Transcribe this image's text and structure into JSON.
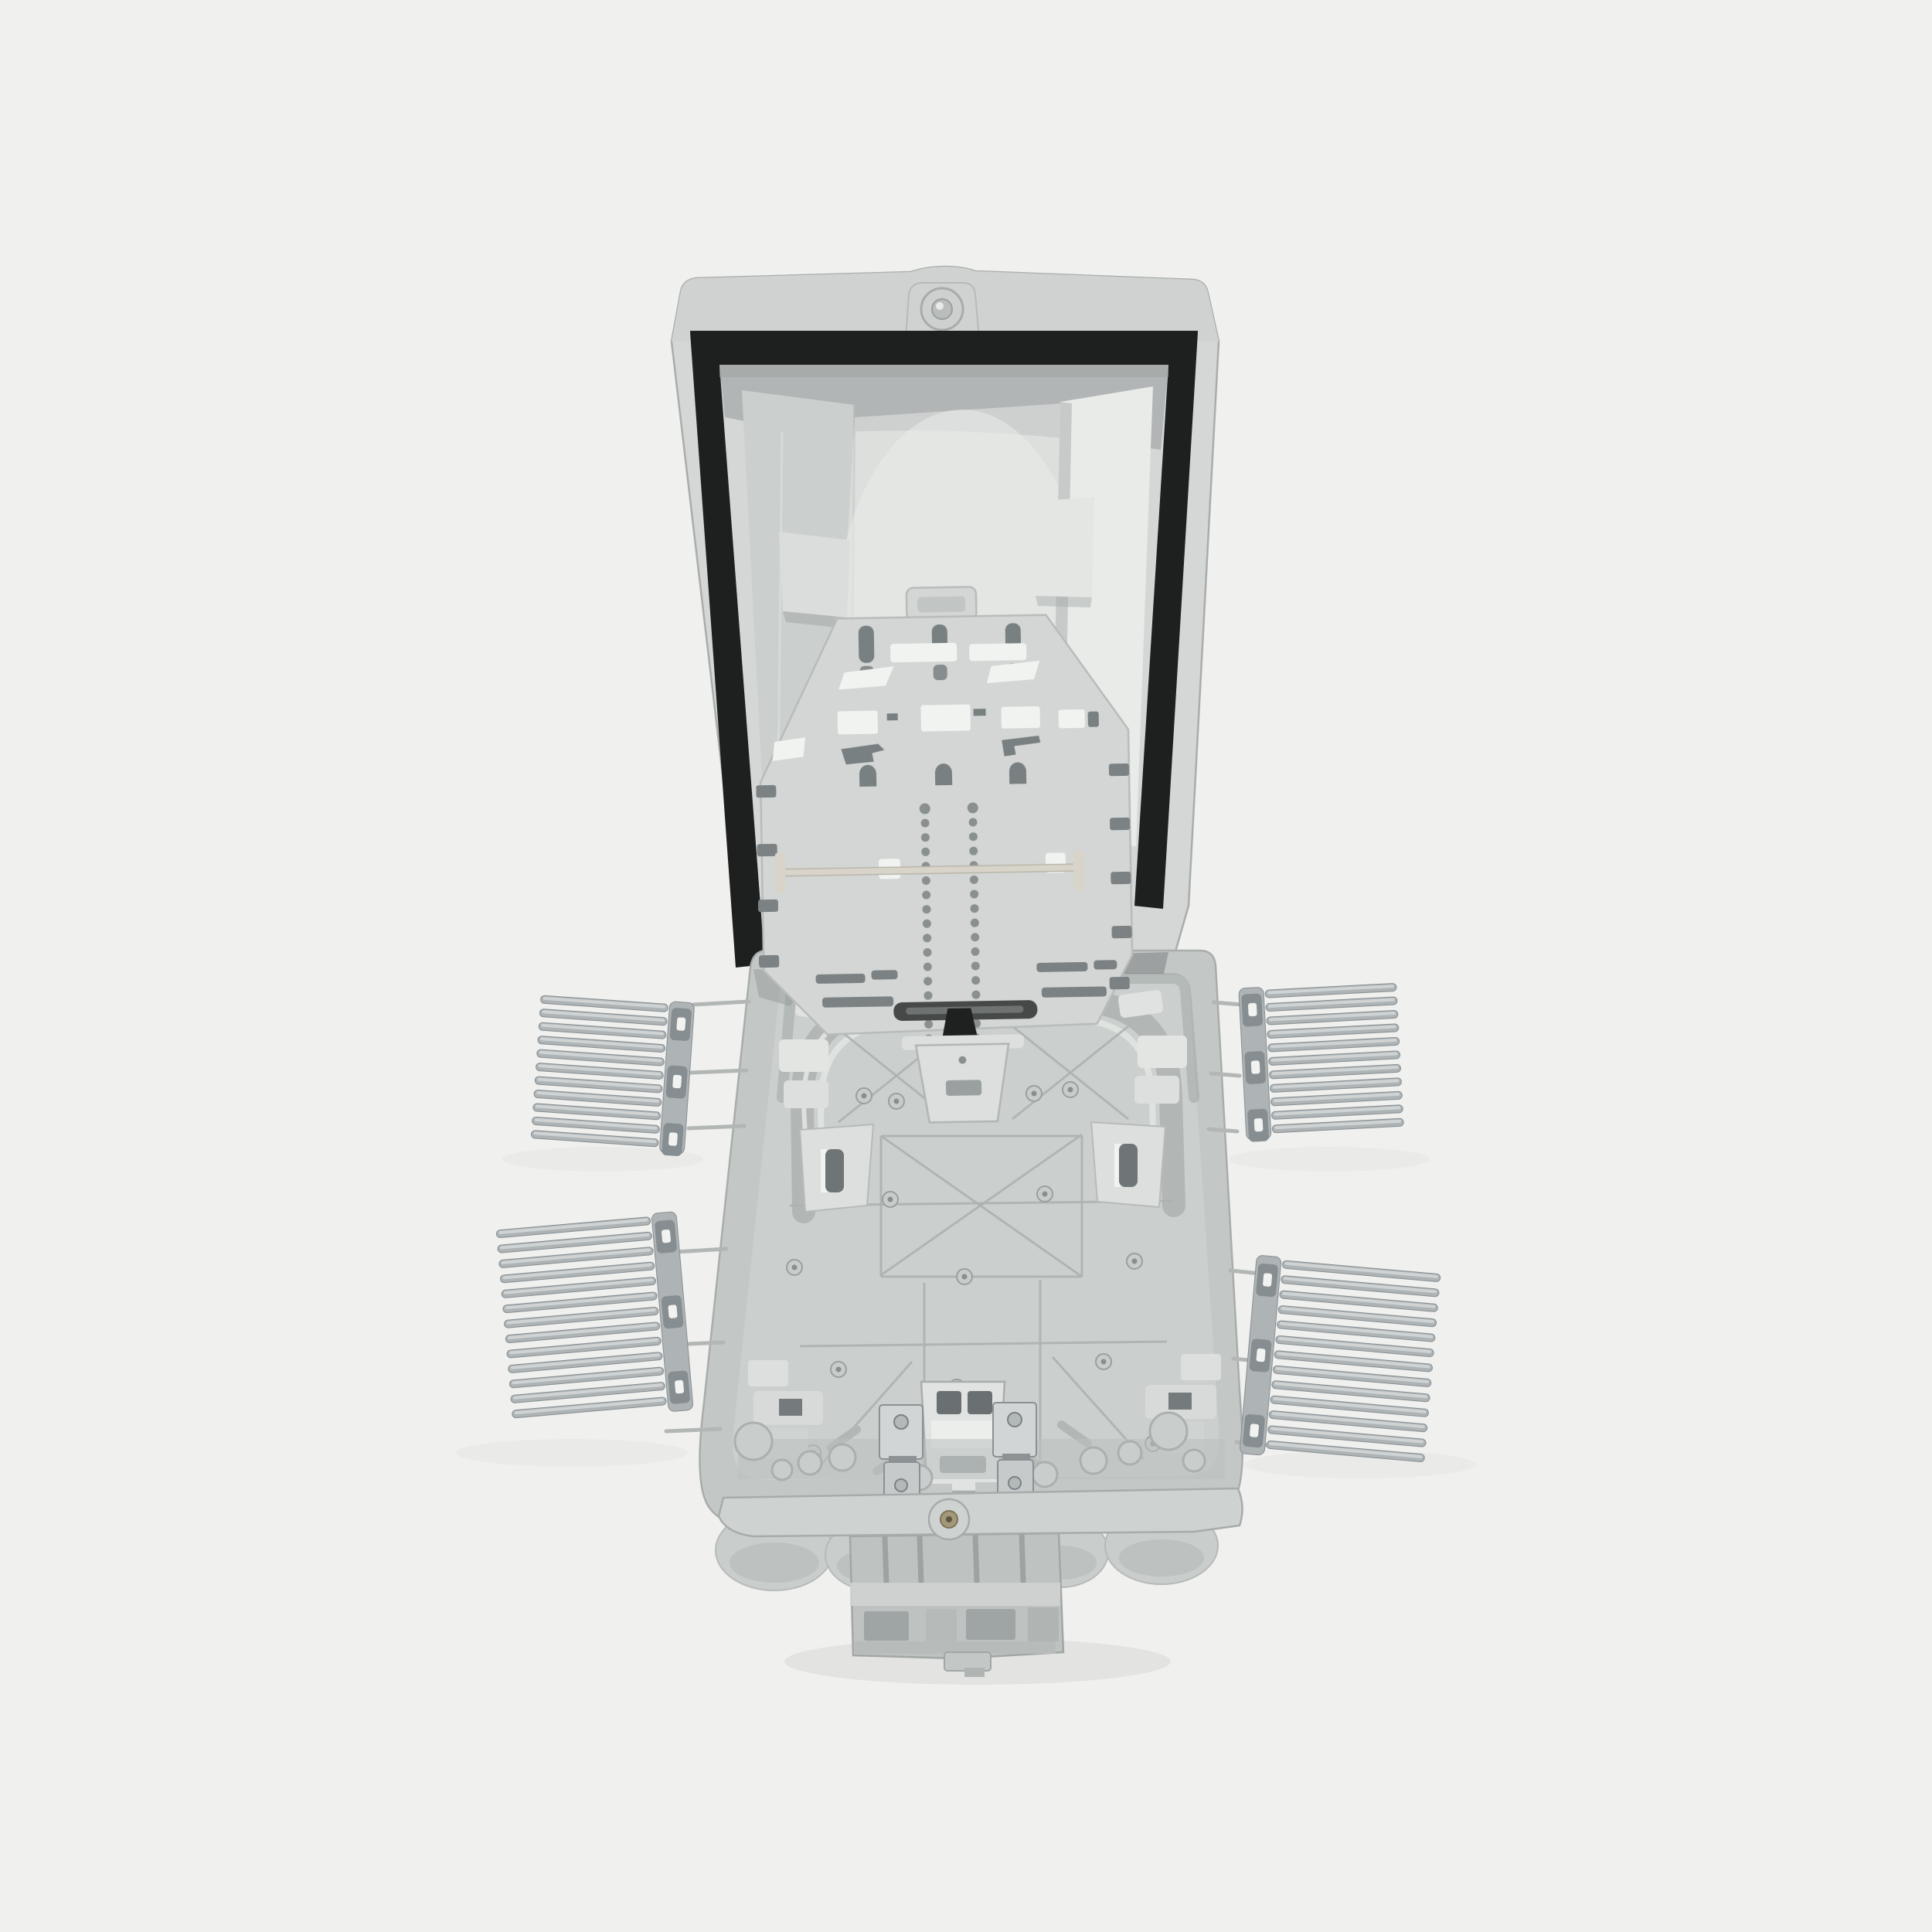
{
  "meta": {
    "type": "product-photograph",
    "subject": "Opened outdoor fiber optic distribution box (FTTH termination enclosure), front view with lid raised",
    "alt_text": "Light grey plastic fiber optic distribution box standing open: raised lid lined with a black rubber gasket seal, a perforated splice tray plate hinged between lid and base, a deep base tray with oval fiber routing track, mounting bosses, brackets and metal cable clamps, four grey comb-style fiber organizers attached by thin pins at the left and right sides, and round cable entry ports with a trunk cable block at the bottom."
  },
  "scene": {
    "background_color": "#f0f0ee",
    "components": {
      "lid": "Hinged lid with black weatherproof gasket and inner stiffening panels",
      "splice_tray": "Fiber splice tray plate with keyhole slots, arch slots, two perforation columns and a cross rod",
      "base": "Enclosure base with oval routing track, rib pattern, slot brackets, latch block and screw bosses",
      "combs": "Four comb-style fiber organizers on side sprue pins",
      "cable_ports": "Round cable entry lobes and ribbed trunk cable block at the bottom"
    }
  },
  "colors": {
    "background": "#f0f0ee",
    "lid_face": "#d4d7d5",
    "lid_rim": "#cfd2d1",
    "lid_top_shadow": "#a8adac",
    "lid_recess": "#cbcfcd",
    "lid_panel": "#e9ebe9",
    "lid_highlight": "#e3e5e3",
    "gasket": "#1e1f1f",
    "tray": "#d3d6d4",
    "tray_edge": "#b7bbba",
    "slot_dark": "#798081",
    "cutout_white": "#f1f3f1",
    "rod": "#d8d4c9",
    "base_wall": "#c3c7c6",
    "base_rim": "#ced2d0",
    "base_floor": "#cbcfcd",
    "rib": "#aeb3b2",
    "bracket": "#dcdfdd",
    "latch": "#e0e3e1",
    "metal": "#d2d5d6",
    "metal_dark": "#868d8f",
    "comb": "#aeb4b6",
    "comb_dark": "#878e91",
    "comb_light": "#d3d6d7",
    "wire": "#b2b6b5",
    "port": "#c9cdcb",
    "trunk": "#bec2c1",
    "trunk_dark": "#9da3a2",
    "screw_gold": "#a4987a"
  },
  "combs": [
    {
      "id": "upper-left",
      "tines": 11
    },
    {
      "id": "lower-left",
      "tines": 13
    },
    {
      "id": "upper-right",
      "tines": 11
    },
    {
      "id": "lower-right",
      "tines": 13
    }
  ],
  "splice_tray": {
    "dot_columns": 2,
    "dots_per_column": 18
  },
  "base": {
    "screw_bosses": 16
  }
}
